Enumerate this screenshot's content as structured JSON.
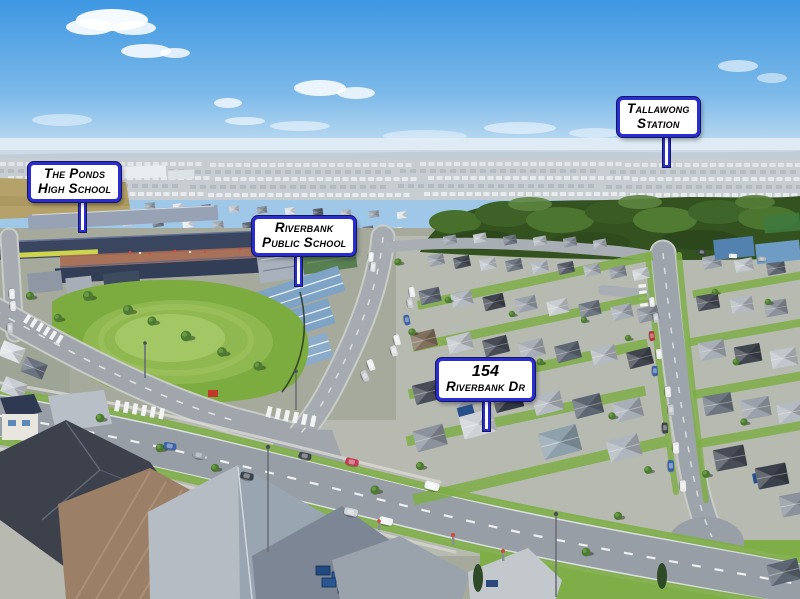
{
  "image": {
    "description": "Aerial drone photograph of a new suburban estate with schools, a sports oval, tree belt and housing streets, annotated with real-estate location callouts"
  },
  "callouts": {
    "ponds_high": {
      "line1": "The Ponds",
      "line2": "High School"
    },
    "riverbank_school": {
      "line1": "Riverbank",
      "line2": "Public School"
    },
    "tallawong_station": {
      "line1": "Tallawong",
      "line2": "Station"
    },
    "property": {
      "line1": "154",
      "line2": "Riverbank Dr"
    }
  },
  "style": {
    "callout_border": "#2a2ed0",
    "callout_background": "#ffffff",
    "callout_text": "#000000"
  }
}
